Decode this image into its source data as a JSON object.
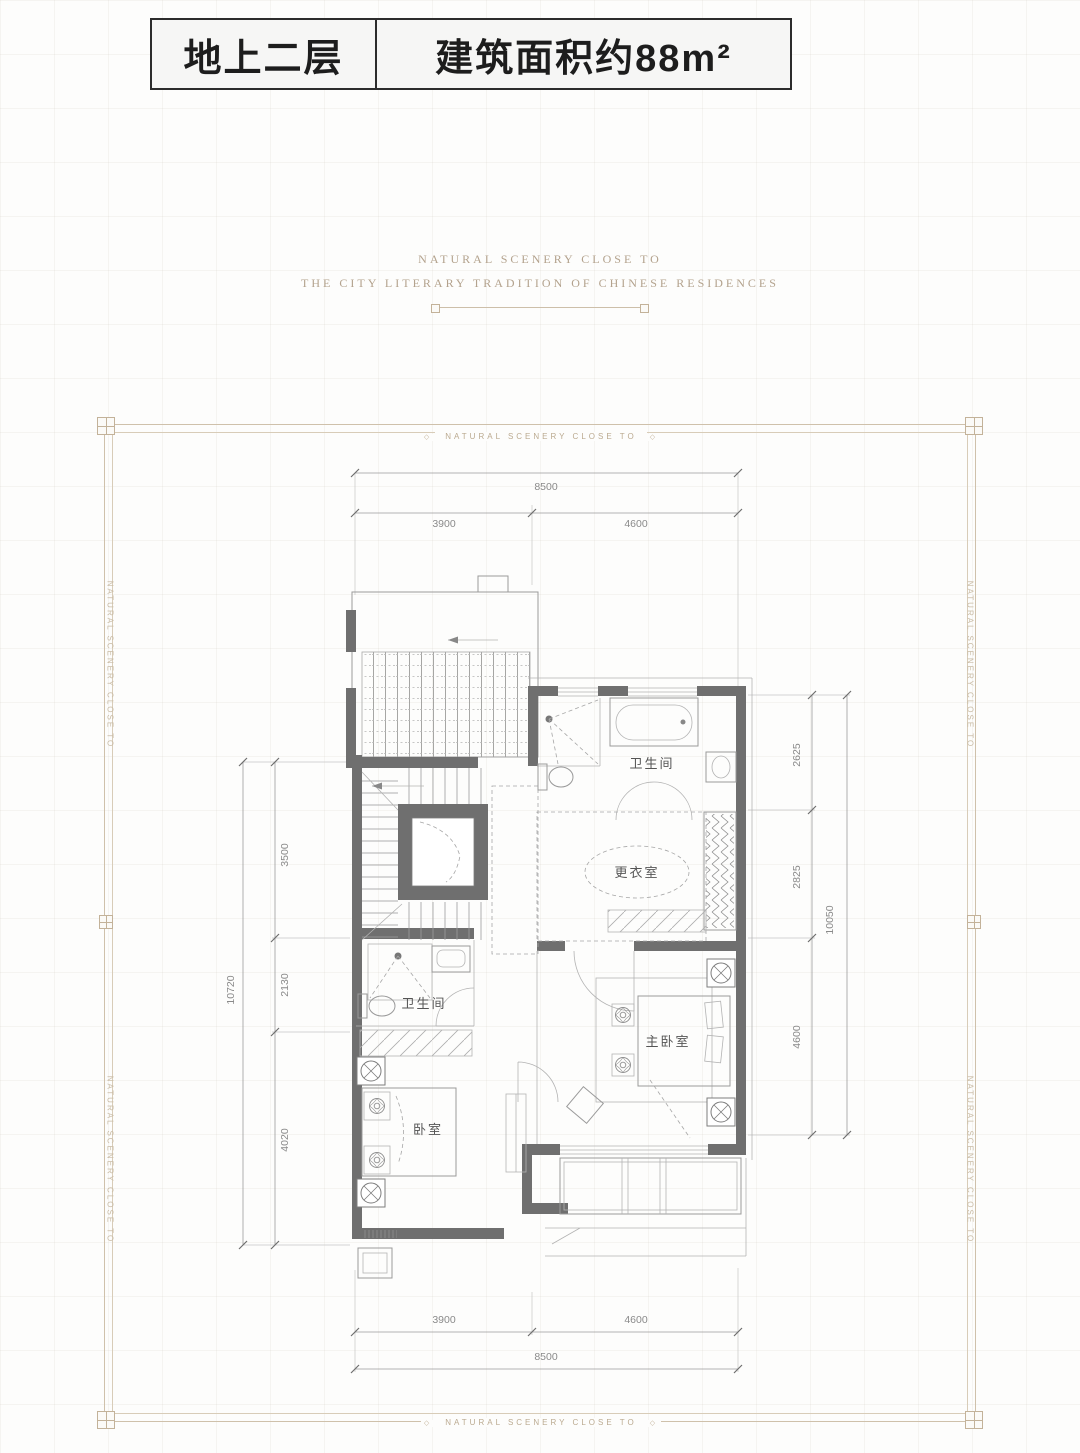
{
  "header": {
    "floor_label": "地上二层",
    "area_label": "建筑面积约88m²"
  },
  "tagline": {
    "line1": "NATURAL SCENERY CLOSE TO",
    "line2": "THE CITY LITERARY TRADITION OF CHINESE RESIDENCES"
  },
  "frame": {
    "border_text": "NATURAL SCENERY CLOSE TO",
    "ornament_glyph": "◇",
    "accent_color": "#c8b9a2"
  },
  "plan": {
    "wall_color": "#6f6f6f",
    "rooms": {
      "bath_upper": "卫生间",
      "dressing": "更衣室",
      "master_bedroom": "主卧室",
      "bath_lower": "卫生间",
      "bedroom": "卧室"
    },
    "dims": {
      "top_total": "8500",
      "top_seg1": "3900",
      "top_seg2": "4600",
      "bottom_seg1": "3900",
      "bottom_seg2": "4600",
      "bottom_total": "8500",
      "left_seg1": "3500",
      "left_seg2": "2130",
      "left_seg3": "4020",
      "left_total": "10720",
      "right_seg1": "2625",
      "right_seg2": "2825",
      "right_seg3": "4600",
      "right_total": "10050"
    }
  }
}
